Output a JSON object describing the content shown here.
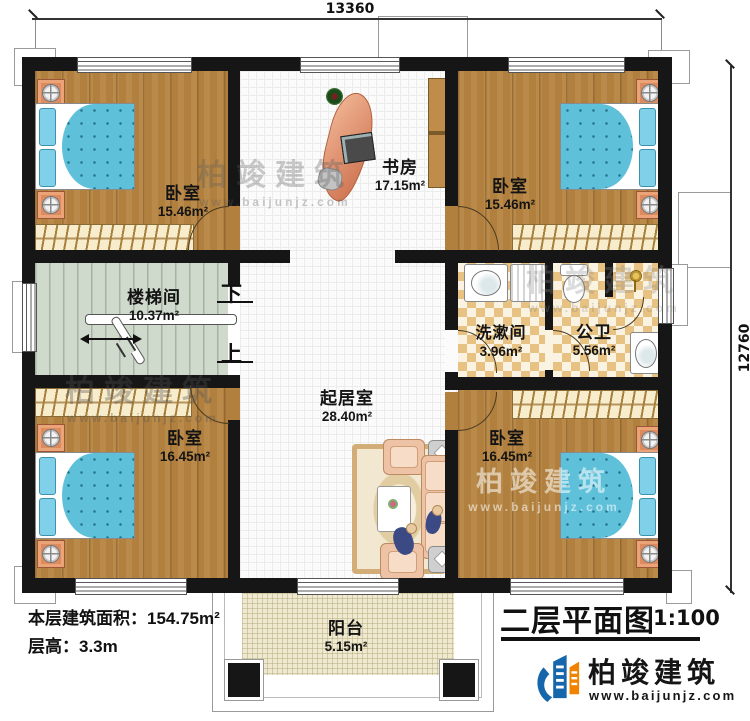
{
  "dimensions": {
    "top": "13360",
    "right": "12760"
  },
  "rooms": {
    "bedroom_top_left": {
      "name": "卧室",
      "area": "15.46m²"
    },
    "study": {
      "name": "书房",
      "area": "17.15m²"
    },
    "bedroom_top_right": {
      "name": "卧室",
      "area": "15.46m²"
    },
    "stairwell": {
      "name": "楼梯间",
      "area": "10.37m²"
    },
    "living_room": {
      "name": "起居室",
      "area": "28.40m²"
    },
    "washroom": {
      "name": "洗漱间",
      "area": "3.96m²"
    },
    "bathroom": {
      "name": "公卫",
      "area": "5.56m²"
    },
    "bedroom_bottom_left": {
      "name": "卧室",
      "area": "16.45m²"
    },
    "bedroom_bottom_right": {
      "name": "卧室",
      "area": "16.45m²"
    },
    "balcony": {
      "name": "阳台",
      "area": "5.15m²"
    }
  },
  "stairs": {
    "down_label": "下",
    "up_label": "上"
  },
  "notes": {
    "floor_area_label": "本层建筑面积：",
    "floor_area_value": "154.75m²",
    "floor_height_label": "层高：",
    "floor_height_value": "3.3m"
  },
  "title_block": {
    "title": "二层平面图",
    "scale": "1:100"
  },
  "branding": {
    "company": "柏竣建筑",
    "website": "www.baijunjz.com"
  },
  "watermark": {
    "text": "柏竣建筑",
    "website": "www.baijunjz.com"
  },
  "colors": {
    "wall": "#161616",
    "wood_floor": "#b1803f",
    "tile_floor": "#fbfbfb",
    "checker_tile": "#e7c282",
    "stair_floor": "#cfd9cc",
    "balcony_floor": "#efe9cf",
    "bed_blue": "#5fc0da",
    "sofa_pink": "#eec2a4",
    "nightstand_orange": "#dc8a5e",
    "logo_blue": "#1566ab",
    "logo_orange": "#f08300"
  }
}
